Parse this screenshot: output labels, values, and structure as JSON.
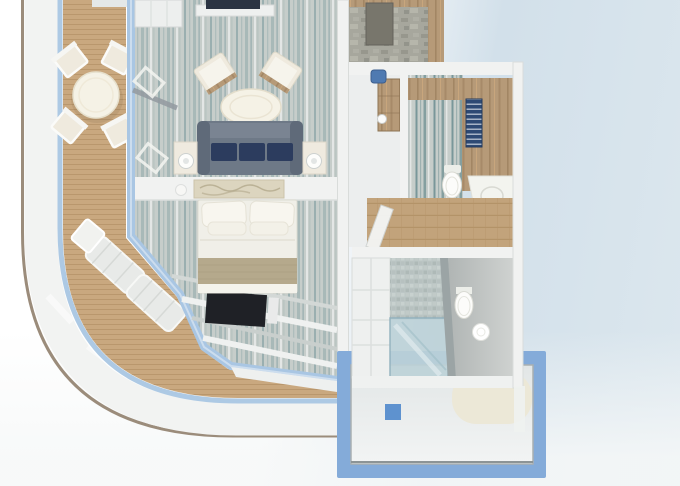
{
  "meta": {
    "title": "Cruise ship suite — 3D cutaway floor plan render",
    "width_px": 680,
    "height_px": 486
  },
  "colors": {
    "bg_blue": "#d2e0ea",
    "hull_white": "#f2f3f2",
    "hull_trim": "#9b8c7b",
    "glass_blue": "#a9c6e3",
    "deck_wood": "#c9a87f",
    "deck_line": "#ab885e",
    "carpet_base": "#c6cdca",
    "carpet_teal": "#6d9195",
    "wallpaper_teal": "#5e8589",
    "entry_carpet": "#a7a79d",
    "oak": "#b69a78",
    "oak_dark": "#9a7e5c",
    "wall_white": "#f1f2f1",
    "sofa_gray": "#6e7987",
    "sofa_navy": "#2c3c5e",
    "chair_cream": "#efeade",
    "table_cream": "#f5f2e6",
    "bed_white": "#f0efe8",
    "runner_beige": "#b5a98c",
    "tv_dark": "#1f2126",
    "stool_blue": "#4f7ab1",
    "towel_navy": "#2e4a74",
    "mosaic_gray": "#bcc6c5",
    "platform_blue": "#84abd9",
    "platform_floor": "#e9ecec",
    "drain_blue": "#5e92cf",
    "tub_beige": "#ece8d7",
    "porcelain": "#fcfcfa"
  },
  "scene": {
    "type": "3d-floorplan-render",
    "subject": "Top-down 3D cutaway of a cruise ship balcony suite",
    "rooms": [
      {
        "name": "balcony",
        "items": [
          "teak deck",
          "round dining table",
          "4 deck chairs",
          "2 sun loungers",
          "curved glass railing",
          "white ship hull band"
        ]
      },
      {
        "name": "living-room",
        "items": [
          "gray sofa with 3 navy cushions",
          "2 side tables with lamps",
          "2 cream armchairs",
          "oval coffee table",
          "TV on shelf",
          "white cabinet",
          "console with artwork"
        ]
      },
      {
        "name": "bedroom",
        "items": [
          "double bed with pillows",
          "beige bed runner",
          "wall TV on window band",
          "floor-to-ceiling window mullions"
        ]
      },
      {
        "name": "entry-hall",
        "items": [
          "mottled carpet",
          "oak wall paneling",
          "dark bench"
        ]
      },
      {
        "name": "dressing-area",
        "items": [
          "oak vanity desk",
          "blue stool",
          "cup"
        ]
      },
      {
        "name": "bathroom-upper",
        "items": [
          "oak wardrobe counter",
          "navy towel shelf",
          "toilet",
          "white vanity with sink",
          "wood plank floor",
          "open door"
        ]
      },
      {
        "name": "bathroom-lower",
        "items": [
          "white storage cabinet",
          "mosaic tile wall",
          "glass shower",
          "gray partition",
          "toilet",
          "round sink"
        ]
      },
      {
        "name": "lower-deck-platform",
        "items": [
          "blue structural frame",
          "light floor panel",
          "blue drain square",
          "beige tub shape"
        ]
      }
    ]
  }
}
